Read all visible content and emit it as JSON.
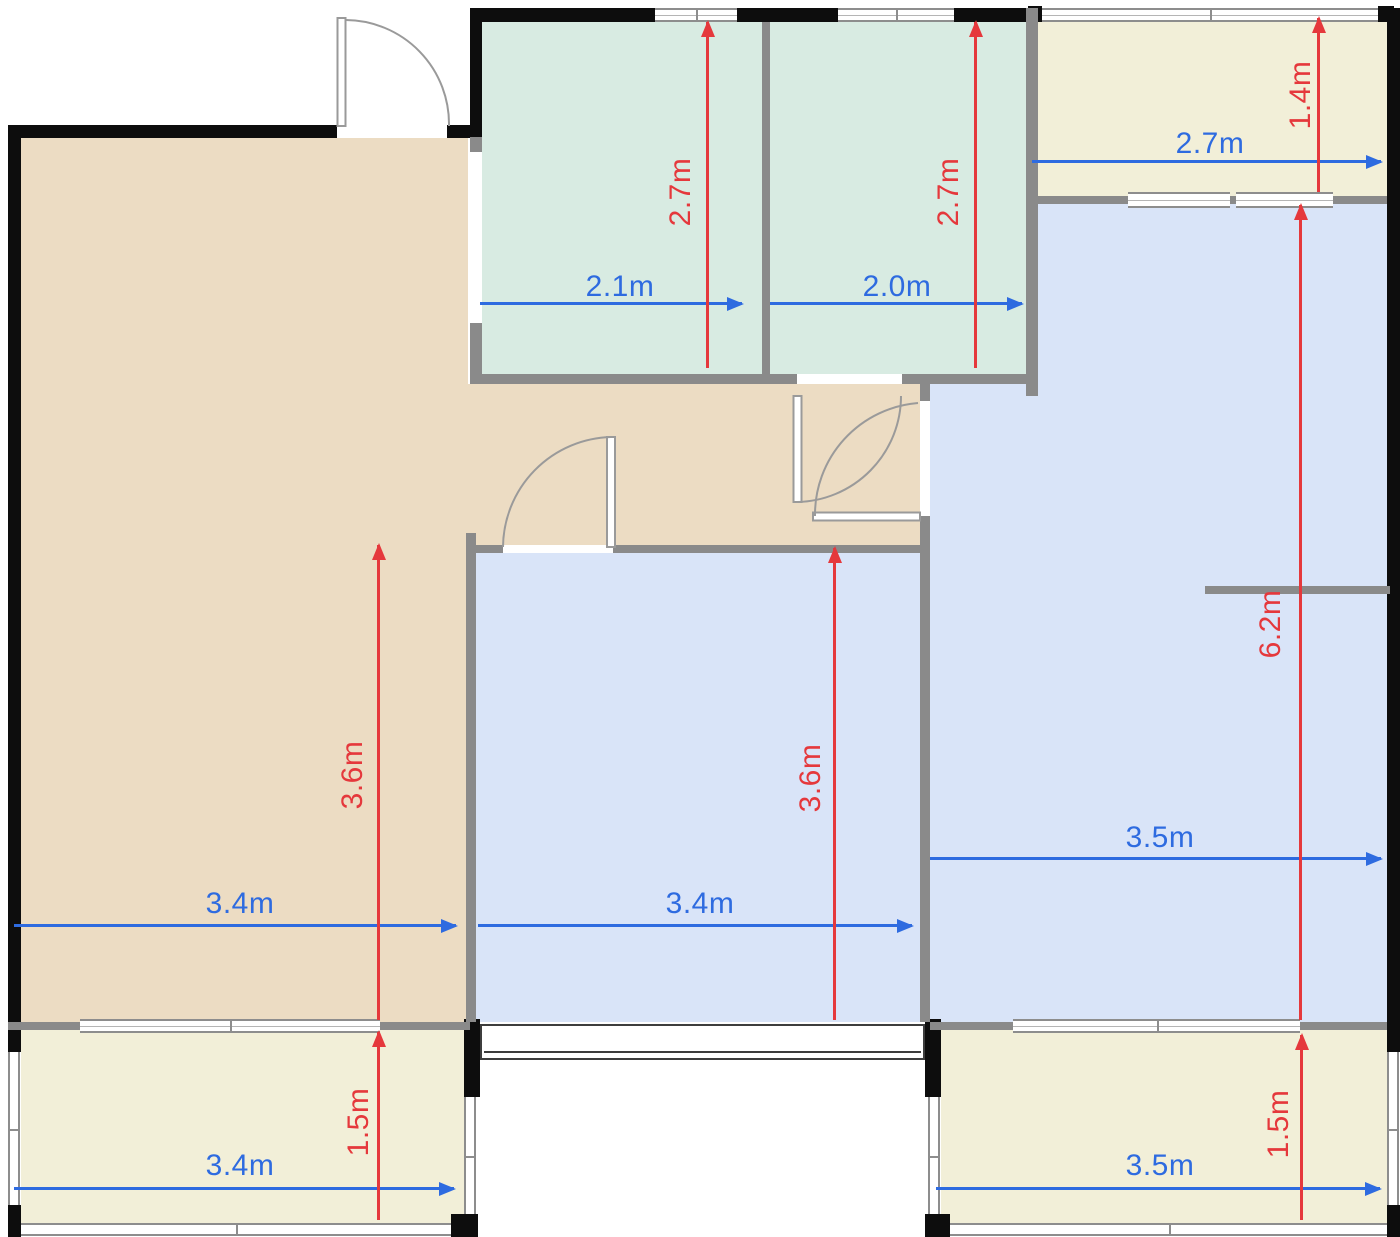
{
  "plan": {
    "type": "floor-plan",
    "rooms": {
      "living_room": {
        "width_label": "3.4m",
        "height_label": "3.6m"
      },
      "bedroom_middle": {
        "width_label": "3.4m",
        "height_label": "3.6m"
      },
      "bedroom_right": {
        "width_label": "3.5m",
        "height_label": "6.2m"
      },
      "bathroom_left": {
        "width_label": "2.1m",
        "height_label": "2.7m"
      },
      "bathroom_right": {
        "width_label": "2.0m",
        "height_label": "2.7m"
      },
      "balcony_top_right": {
        "width_label": "2.7m",
        "height_label": "1.4m"
      },
      "balcony_bottom_left": {
        "width_label": "3.4m",
        "height_label": "1.5m"
      },
      "balcony_bottom_right": {
        "width_label": "3.5m",
        "height_label": "1.5m"
      }
    },
    "colors": {
      "living_fill": "#ecdcc3",
      "bedroom_fill": "#d9e4f8",
      "bathroom_fill": "#d8ebe2",
      "balcony_fill": "#f2efd8",
      "wall_exterior": "#0d0d0d",
      "wall_interior": "#8a8a8a",
      "dim_horizontal": "#2e6be0",
      "dim_vertical": "#e5383c"
    }
  }
}
